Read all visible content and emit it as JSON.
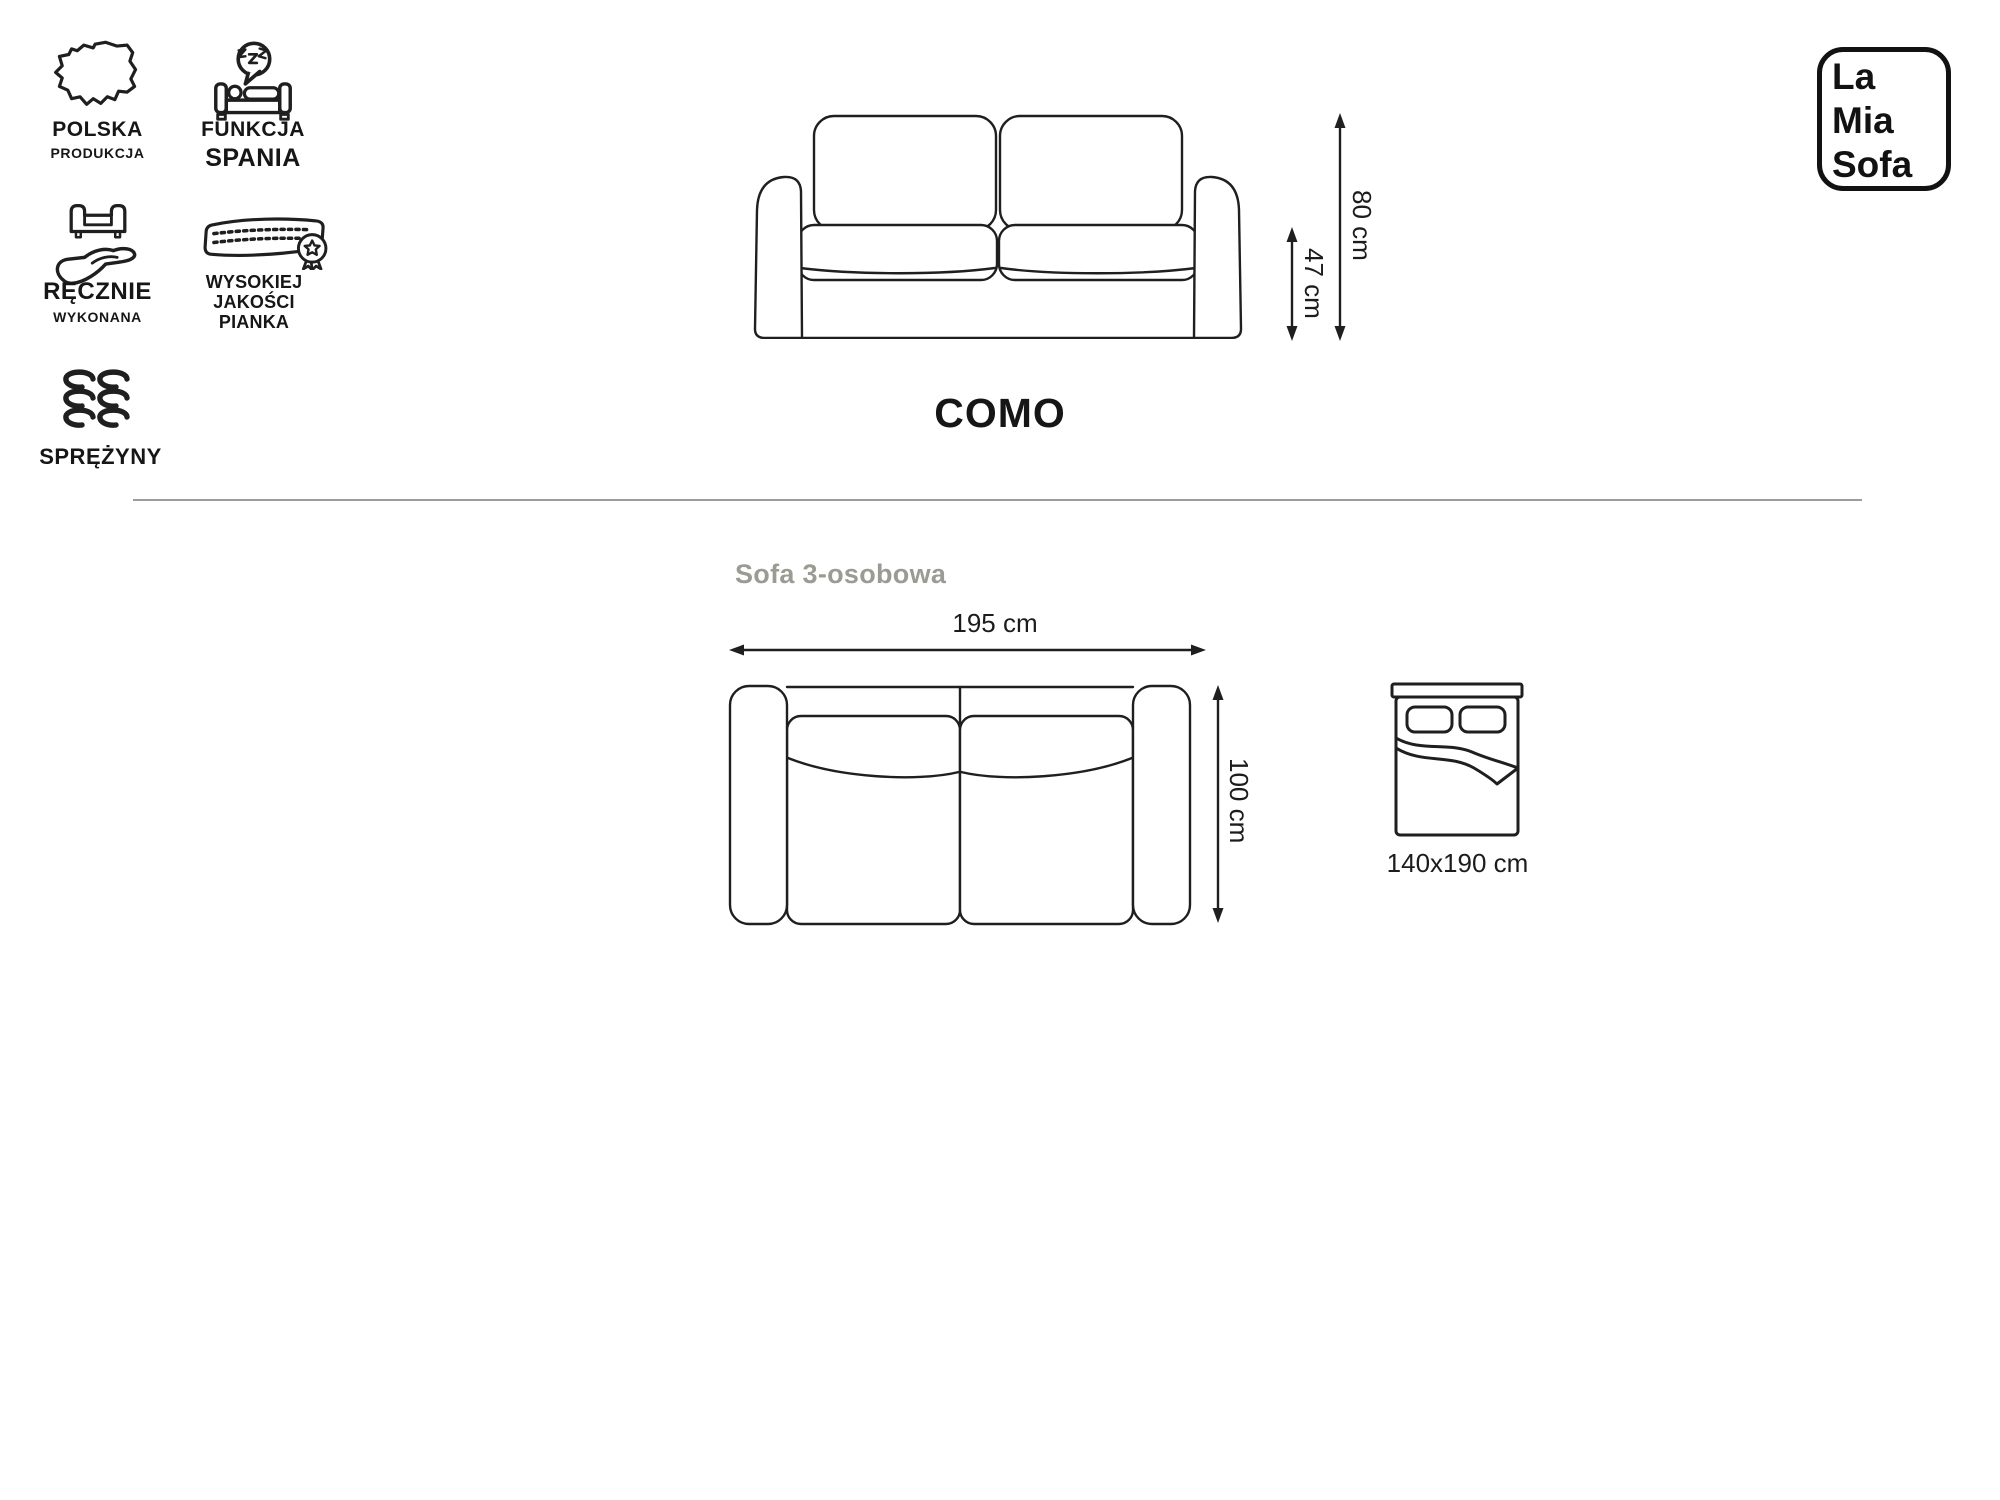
{
  "brand": {
    "line1": "La",
    "line2": "Mia",
    "line3": "Sofa"
  },
  "features": {
    "polska": {
      "title": "POLSKA",
      "subtitle": "PRODUKCJA",
      "icon": "poland-map-icon"
    },
    "spanie": {
      "title": "FUNKCJA",
      "subtitle": "SPANIA",
      "icon": "sleep-function-icon"
    },
    "recznie": {
      "title": "RĘCZNIE",
      "subtitle": "WYKONANA",
      "icon": "handmade-icon"
    },
    "pianka": {
      "title": "WYSOKIEJ",
      "subtitle": "JAKOŚCI PIANKA",
      "icon": "foam-quality-icon"
    },
    "sprezyny": {
      "title": "SPRĘŻYNY",
      "icon": "springs-icon"
    }
  },
  "product": {
    "name": "COMO",
    "variant": "Sofa 3-osobowa"
  },
  "dimensions": {
    "total_height": "80 cm",
    "seat_height": "47 cm",
    "width": "195 cm",
    "depth": "100 cm",
    "bed_surface": "140x190 cm"
  },
  "colors": {
    "ink": "#1f1f1f",
    "muted_text": "#9b9b93",
    "divider": "#9c9c9c",
    "background": "#ffffff"
  }
}
